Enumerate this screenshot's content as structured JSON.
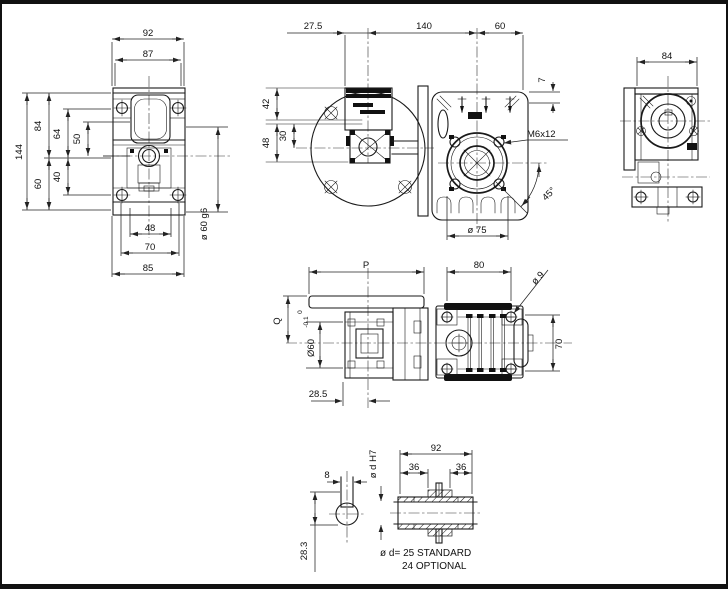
{
  "drawing": {
    "colors": {
      "line": "#1a1a1a",
      "background": "#ffffff"
    },
    "front": {
      "w92": "92",
      "w87": "87",
      "h144": "144",
      "h84": "84",
      "h64": "64",
      "h50": "50",
      "h60": "60",
      "h40": "40",
      "b48": "48",
      "b70": "70",
      "b85": "85",
      "shaft": "ø 60 g6"
    },
    "top": {
      "d27": "27.5",
      "d140": "140",
      "d60": "60",
      "d42": "42",
      "d48": "48",
      "d30": "30",
      "d7": "7",
      "thread": "M6x12",
      "bolt_circle": "ø 75",
      "angle": "45°"
    },
    "side": {
      "w84": "84"
    },
    "lateral": {
      "p": "P",
      "d80": "80",
      "d9": "ø 9",
      "q": "Q",
      "hub": "Ø60",
      "tol_hi": "0",
      "tol_lo": "-0.1",
      "d70": "70",
      "d285": "28.5"
    },
    "shaft_detail": {
      "d8": "8",
      "d283": "28.3",
      "d92": "92",
      "d36a": "36",
      "d36b": "36",
      "bore": "ø d H7",
      "note1": "ø d= 25 STANDARD",
      "note2": "24 OPTIONAL"
    }
  }
}
